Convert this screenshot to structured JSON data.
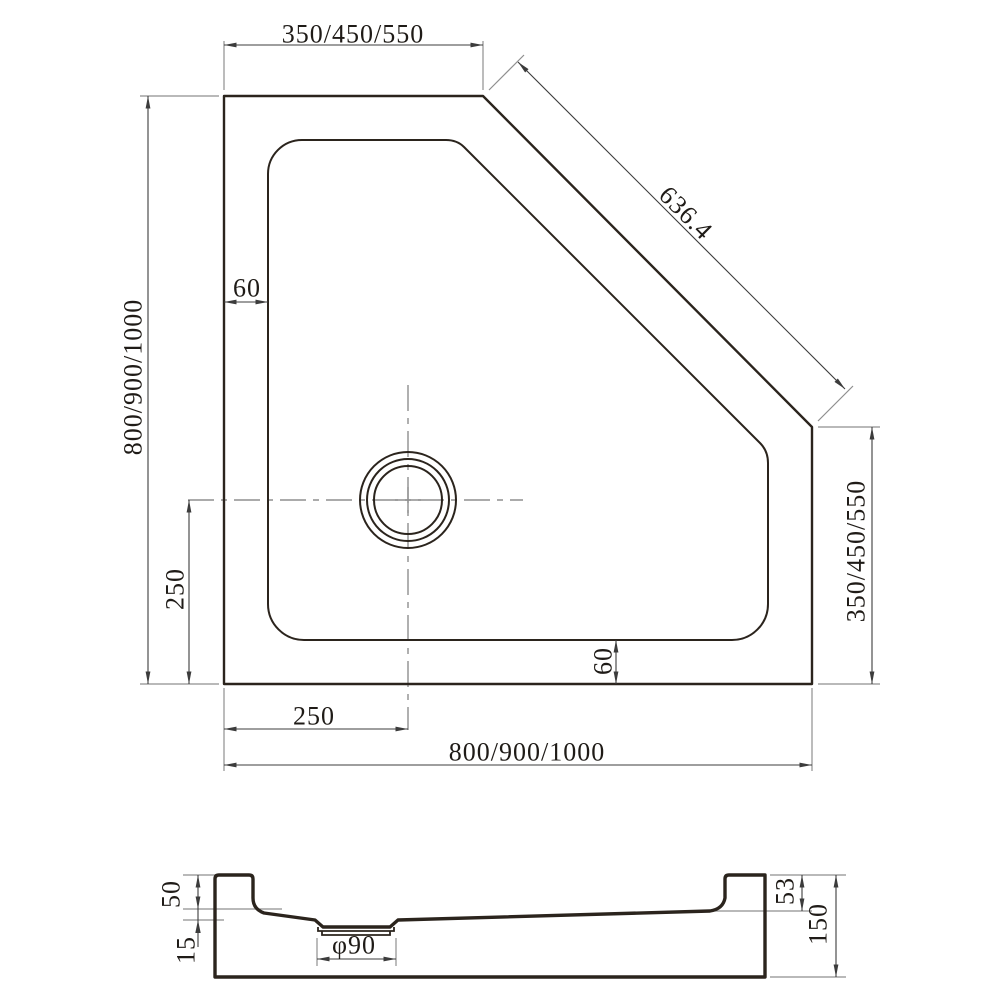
{
  "drawing": {
    "top_view": {
      "dim_top_width": "350/450/550",
      "dim_diagonal_length": "636.4",
      "dim_left_height": "800/900/1000",
      "dim_right_side": "350/450/550",
      "dim_rim_left": "60",
      "dim_rim_bottom": "60",
      "dim_drain_offset_vertical": "250",
      "dim_drain_offset_horizontal": "250",
      "dim_bottom_width": "800/900/1000"
    },
    "section_view": {
      "dim_rim_to_floor_left": "50",
      "dim_floor_drop": "15",
      "dim_drain_diameter": "φ90",
      "dim_rim_to_floor_right": "53",
      "dim_total_height": "150"
    },
    "colors": {
      "outline": "#2b241d",
      "dimension": "#3c3c3c",
      "extension": "#8f8f8f",
      "background": "#ffffff"
    }
  }
}
